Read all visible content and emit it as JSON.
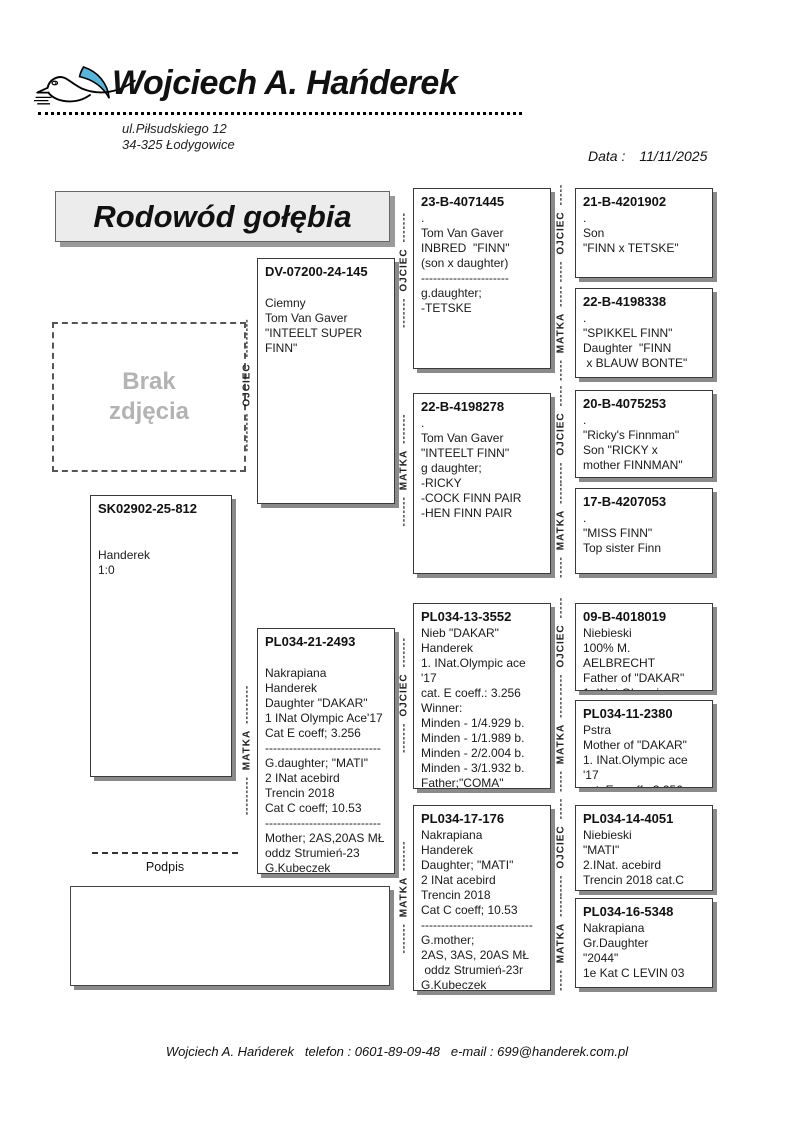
{
  "header": {
    "owner_name": "Wojciech A. Hańderek",
    "address": [
      "ul.Piłsudskiego 12",
      "34-325 Łodygowice"
    ],
    "date_label": "Data :",
    "date_value": "11/11/2025"
  },
  "title": "Rodowód gołębia",
  "photo_placeholder": [
    "Brak",
    "zdjęcia"
  ],
  "signature_label": "Podpis",
  "footer": {
    "text": "Wojciech A. Hańderek   telefon : 0601-89-09-48   e-mail : 699@handerek.com.pl"
  },
  "labels": {
    "father": "OJCIEC",
    "mother": "MATKA"
  },
  "dashes": {
    "long": "---------",
    "mid": "-------",
    "short": "-----"
  },
  "colors": {
    "wing_blue": "#58b4d8",
    "box_shadow": "#8a8a8a",
    "title_bg": "#ececec"
  },
  "pigeons": [
    {
      "id": "SK02902-25-812",
      "lines": [
        "",
        "",
        "Handerek",
        "1:0"
      ]
    },
    {
      "id": "DV-07200-24-145",
      "lines": [
        "",
        "Ciemny",
        "Tom Van Gaver",
        "\"INTEELT SUPER",
        "FINN\""
      ]
    },
    {
      "id": "PL034-21-2493",
      "lines": [
        "",
        "Nakrapiana",
        "Handerek",
        "Daughter \"DAKAR\"",
        "1 INat Olympic Ace'17",
        "Cat E coeff; 3.256",
        "-----------------------------",
        "G.daughter; \"MATI\"",
        "2 INat acebird",
        "Trencin 2018",
        "Cat C coeff; 10.53",
        "-----------------------------",
        "Mother; 2AS,20AS MŁ",
        "oddz Strumień-23",
        "G.Kubeczek"
      ]
    },
    {
      "id": "23-B-4071445",
      "lines": [
        ".",
        "Tom Van Gaver",
        "INBRED  \"FINN\"",
        "(son x daughter)",
        "----------------------",
        "g.daughter;",
        "-TETSKE"
      ]
    },
    {
      "id": "22-B-4198278",
      "lines": [
        ".",
        "Tom Van Gaver",
        "\"INTEELT FINN\"",
        "g daughter;",
        "-RICKY",
        "-COCK FINN PAIR",
        "-HEN FINN PAIR"
      ]
    },
    {
      "id": "PL034-13-3552",
      "lines": [
        "Nieb \"DAKAR\"",
        "Handerek",
        "1. INat.Olympic ace '17",
        "cat. E coeff.: 3.256",
        "Winner:",
        "Minden - 1/4.929 b.",
        "Minden - 1/1.989 b.",
        "Minden - 2/2.004 b.",
        "Minden - 3/1.932 b.",
        "Father;\"COMA\"",
        "2 INat Olympic Ace'22"
      ]
    },
    {
      "id": "PL034-17-176",
      "lines": [
        "Nakrapiana",
        "Handerek",
        "Daughter; \"MATI\"",
        "2 INat acebird",
        "Trencin 2018",
        "Cat C coeff; 10.53",
        "----------------------------",
        "G.mother;",
        "2AS, 3AS, 20AS MŁ",
        " oddz Strumień-23r",
        "G.Kubeczek"
      ]
    },
    {
      "id": "21-B-4201902",
      "lines": [
        ".",
        "Son",
        "\"FINN x TETSKE\""
      ]
    },
    {
      "id": "22-B-4198338",
      "lines": [
        ".",
        "\"SPIKKEL FINN\"",
        "Daughter  \"FINN",
        " x BLAUW BONTE\""
      ]
    },
    {
      "id": "20-B-4075253",
      "lines": [
        ".",
        "\"Ricky's Finnman\"",
        "Son \"RICKY x",
        "mother FINNMAN\""
      ]
    },
    {
      "id": "17-B-4207053",
      "lines": [
        ".",
        "\"MISS FINN\"",
        "Top sister Finn"
      ]
    },
    {
      "id": "09-B-4018019",
      "lines": [
        "Niebieski",
        "100% M. AELBRECHT",
        "Father of \"DAKAR\"",
        "1. INat.Olympic ace '17"
      ]
    },
    {
      "id": "PL034-11-2380",
      "lines": [
        "Pstra",
        "Mother of \"DAKAR\"",
        "1. INat.Olympic ace '17",
        "cat. E coeff.: 3.256"
      ]
    },
    {
      "id": "PL034-14-4051",
      "lines": [
        "Niebieski",
        "\"MATI\"",
        "2.INat. acebird",
        "Trencin 2018 cat.C"
      ]
    },
    {
      "id": "PL034-16-5348",
      "lines": [
        "Nakrapiana",
        "Gr.Daughter",
        "\"2044\"",
        "1e Kat C LEVIN 03"
      ]
    }
  ]
}
